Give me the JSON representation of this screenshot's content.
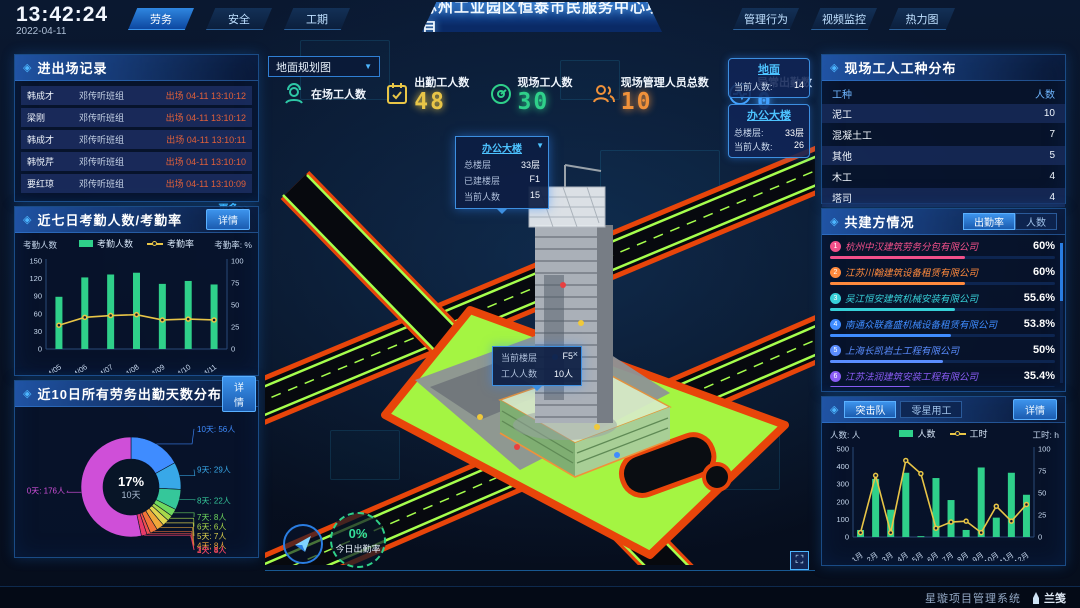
{
  "header": {
    "time": "13:42:24",
    "date": "2022-04-11",
    "nav_left": [
      {
        "label": "劳务",
        "active": true
      },
      {
        "label": "安全",
        "active": false
      },
      {
        "label": "工期",
        "active": false
      }
    ],
    "title": "苏州工业园区恒泰市民服务中心项目",
    "nav_right": [
      {
        "label": "管理行为",
        "active": false
      },
      {
        "label": "视频监控",
        "active": false
      },
      {
        "label": "热力图",
        "active": false
      }
    ]
  },
  "entry_exit_panel": {
    "title": "进出场记录",
    "more_label": "更多>>",
    "records": [
      {
        "name": "韩成才",
        "team": "邓传听班组",
        "event": "出场 04-11 13:10:12"
      },
      {
        "name": "梁刚",
        "team": "邓传听班组",
        "event": "出场 04-11 13:10:12"
      },
      {
        "name": "韩成才",
        "team": "邓传听班组",
        "event": "出场 04-11 13:10:11"
      },
      {
        "name": "韩悦芹",
        "team": "邓传听班组",
        "event": "出场 04-11 13:10:10"
      },
      {
        "name": "要红琼",
        "team": "邓传听班组",
        "event": "出场 04-11 13:10:09"
      }
    ]
  },
  "attendance_panel": {
    "title": "近七日考勤人数/考勤率",
    "detail_label": "详情"
  },
  "distribution_panel": {
    "title": "近10日所有劳务出勤天数分布",
    "detail_label": "详情"
  },
  "map": {
    "view_select": "地面规划图",
    "stats": [
      {
        "label": "在场工人数",
        "value": "",
        "color": "#2ec7a6",
        "icon": "worker-icon"
      },
      {
        "label": "出勤工人数",
        "value": "48",
        "color": "#e8c547",
        "icon": "calendar-check-icon"
      },
      {
        "label": "现场工人数",
        "value": "30",
        "color": "#2fd08a",
        "icon": "gauge-icon"
      },
      {
        "label": "现场管理人员总数",
        "value": "10",
        "color": "#f0913a",
        "icon": "people-icon"
      },
      {
        "label": "异常出勤数",
        "value": "0",
        "color": "#49a8ff",
        "icon": "pulse-icon"
      }
    ],
    "building_tooltip": {
      "title": "办公大楼",
      "rows": [
        {
          "k": "总楼层",
          "v": "33层"
        },
        {
          "k": "已建楼层",
          "v": "F1"
        },
        {
          "k": "当前人数",
          "v": "15"
        }
      ]
    },
    "floor_tooltip": {
      "close": "×",
      "rows": [
        {
          "k": "当前楼层",
          "v": "F5"
        },
        {
          "k": "工人人数",
          "v": "10人"
        }
      ]
    },
    "location_cards": [
      {
        "title": "地面",
        "rows": [
          {
            "k": "当前人数:",
            "v": "14"
          }
        ]
      },
      {
        "title": "办公大楼",
        "rows": [
          {
            "k": "总楼层:",
            "v": "33层"
          },
          {
            "k": "当前人数:",
            "v": "26"
          }
        ]
      }
    ],
    "gauge": {
      "value": "0%",
      "label": "今日出勤率"
    }
  },
  "worker_type_panel": {
    "title": "现场工人工种分布",
    "headers": [
      "工种",
      "人数"
    ],
    "rows": [
      {
        "type": "泥工",
        "count": "10"
      },
      {
        "type": "混凝土工",
        "count": "7"
      },
      {
        "type": "其他",
        "count": "5"
      },
      {
        "type": "木工",
        "count": "4"
      },
      {
        "type": "塔司",
        "count": "4"
      }
    ]
  },
  "partners_panel": {
    "title": "共建方情况",
    "tabs": [
      {
        "label": "出勤率",
        "active": true
      },
      {
        "label": "人数",
        "active": false
      }
    ],
    "companies": [
      {
        "rank": "1",
        "name": "杭州中汉建筑劳务分包有限公司",
        "value": "60%",
        "pct": 60,
        "color": "#f2508a"
      },
      {
        "rank": "2",
        "name": "江苏川翰建筑设备租赁有限公司",
        "value": "60%",
        "pct": 60,
        "color": "#ff8a3d"
      },
      {
        "rank": "3",
        "name": "吴江恒安建筑机械安装有限公司",
        "value": "55.6%",
        "pct": 55.6,
        "color": "#37d0d8"
      },
      {
        "rank": "4",
        "name": "南通众联鑫盛机械设备租赁有限公司",
        "value": "53.8%",
        "pct": 53.8,
        "color": "#3f8cff"
      },
      {
        "rank": "5",
        "name": "上海长凯岩土工程有限公司",
        "value": "50%",
        "pct": 50,
        "color": "#5a8dff"
      },
      {
        "rank": "6",
        "name": "江苏法润建筑安装工程有限公司",
        "value": "35.4%",
        "pct": 35.4,
        "color": "#8a5cf5"
      }
    ]
  },
  "squad_panel": {
    "tabs": [
      {
        "label": "突击队",
        "active": true
      },
      {
        "label": "零星用工",
        "active": false
      }
    ],
    "detail_label": "详情"
  },
  "footer": {
    "system": "星璇项目管理系统",
    "logo": "兰笺"
  },
  "chart_data": [
    {
      "id": "attendance_chart",
      "type": "bar",
      "title": "近七日考勤人数/考勤率",
      "categories": [
        "04/05",
        "04/06",
        "04/07",
        "04/08",
        "04/09",
        "04/10",
        "04/11"
      ],
      "series": [
        {
          "name": "考勤人数",
          "type": "bar",
          "color": "#2fd08a",
          "axis": "left",
          "values": [
            89,
            122,
            127,
            130,
            111,
            116,
            110
          ]
        },
        {
          "name": "考勤率",
          "type": "line",
          "color": "#e8c547",
          "axis": "right",
          "values": [
            27,
            36,
            38,
            39,
            33,
            34,
            33
          ]
        }
      ],
      "left_axis": {
        "label": "考勤人数",
        "min": 0,
        "max": 150,
        "step": 30
      },
      "right_axis": {
        "label": "考勤率: %",
        "min": 0,
        "max": 100,
        "step": 25
      },
      "legend_position": "top",
      "grid": false
    },
    {
      "id": "distribution_donut",
      "type": "pie",
      "title": "近10日所有劳务出勤天数分布",
      "center": {
        "pct": "17%",
        "label": "10天"
      },
      "slices": [
        {
          "label": "10天: 56人",
          "value": 56,
          "color": "#3f8cff"
        },
        {
          "label": "9天: 29人",
          "value": 29,
          "color": "#38a8e8"
        },
        {
          "label": "8天: 22人",
          "value": 22,
          "color": "#35c79a"
        },
        {
          "label": "7天: 8人",
          "value": 8,
          "color": "#6fd95f"
        },
        {
          "label": "6天: 6人",
          "value": 6,
          "color": "#a8d84a"
        },
        {
          "label": "5天: 7人",
          "value": 7,
          "color": "#e0d44f"
        },
        {
          "label": "4天: 8人",
          "value": 8,
          "color": "#f0a83a"
        },
        {
          "label": "3天: 8人",
          "value": 8,
          "color": "#f07438"
        },
        {
          "label": "2天: 4人",
          "value": 4,
          "color": "#ef4f4f"
        },
        {
          "label": "1天: 6人",
          "value": 6,
          "color": "#e83a6a"
        },
        {
          "label": "0天: 176人",
          "value": 176,
          "color": "#cf4fd8"
        }
      ]
    },
    {
      "id": "squad_chart",
      "type": "bar",
      "title": "突击队 人数/工时",
      "categories": [
        "1月",
        "2月",
        "3月",
        "4月",
        "5月",
        "6月",
        "7月",
        "8月",
        "9月",
        "10月",
        "11月",
        "12月"
      ],
      "series": [
        {
          "name": "人数",
          "type": "bar",
          "color": "#2fd08a",
          "axis": "left",
          "values": [
            40,
            330,
            155,
            365,
            5,
            335,
            210,
            40,
            395,
            110,
            365,
            240
          ]
        },
        {
          "name": "工时",
          "type": "line",
          "color": "#e8c547",
          "axis": "right",
          "values": [
            5,
            70,
            5,
            87,
            72,
            10,
            17,
            18,
            5,
            35,
            18,
            37
          ]
        }
      ],
      "left_axis": {
        "label": "人数: 人",
        "min": 0,
        "max": 500,
        "step": 100
      },
      "right_axis": {
        "label": "工时: h",
        "min": 0,
        "max": 100,
        "step": 25
      },
      "legend_position": "top",
      "grid": false
    }
  ]
}
